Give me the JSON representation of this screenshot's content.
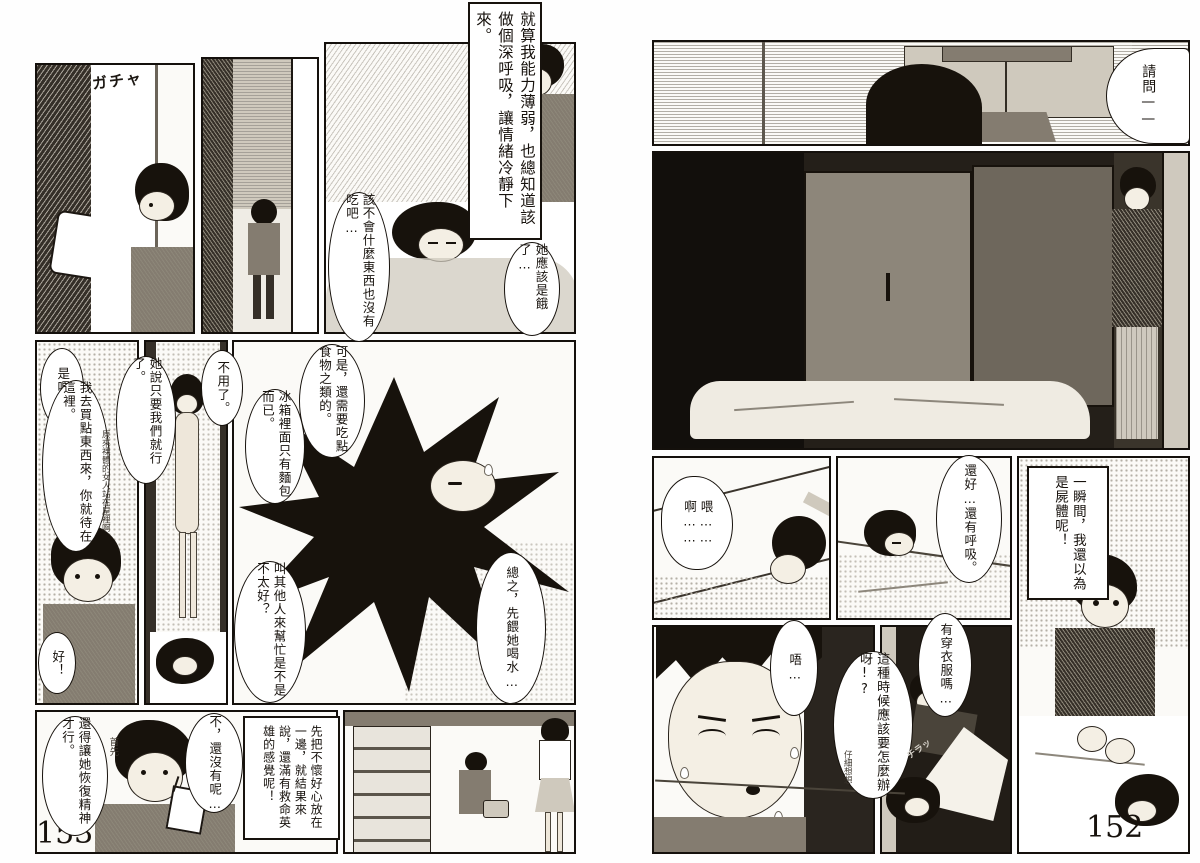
{
  "colors": {
    "paper": "#fbfaf7",
    "ink": "#17120c",
    "tone_gray": "#847c70",
    "dark_room": "#241f19"
  },
  "page_left": {
    "page_number": "153",
    "sfx_door": "ガチャ",
    "caption_calm": "就算我能力薄弱，也總知道該做個深呼吸，讓情緒冷靜下來。",
    "thought_no_food": "該不會什麼東西也沒有吃吧…",
    "thought_hungry": "她應該是餓了…",
    "speech_i_see": "是喔…",
    "speech_go_buy": "我去買點東西來，你就待在這裡。",
    "note_naked": "原來裸體的女人站在屋裡啊",
    "speech_she_said": "她說只要我們就行了。",
    "speech_no_need": "不用了。",
    "speech_ok": "好！",
    "speech_but_food": "可是，還需要吃點食物之類的。",
    "speech_fridge": "冰箱裡面只有麵包而已。",
    "speech_call_others": "叫其他人來幫忙是不是不太好？",
    "speech_water": "總之，先餵她喝水…",
    "thought_recover": "還得讓她恢復精神才行。",
    "note_first": "首先",
    "thought_not_yet": "不，還沒有呢…",
    "caption_hero": "先把不懷好心放在一邊，就結果來說，還滿有救命英雄的感覺呢！"
  },
  "page_right": {
    "page_number": "152",
    "speech_excuse_me": "請問——",
    "speech_ah": "啊……",
    "speech_hey": "喂……",
    "speech_breathing": "還好…還有呼吸。",
    "caption_corpse": "一瞬間，我還以為是屍體呢！",
    "speech_ugh": "唔…",
    "speech_clothes": "有穿衣服嗎…",
    "speech_what_to_do": "這種時候應該要怎麼辦呀!?",
    "note_think": "仔細想想",
    "sfx_glance": "チラッ"
  }
}
